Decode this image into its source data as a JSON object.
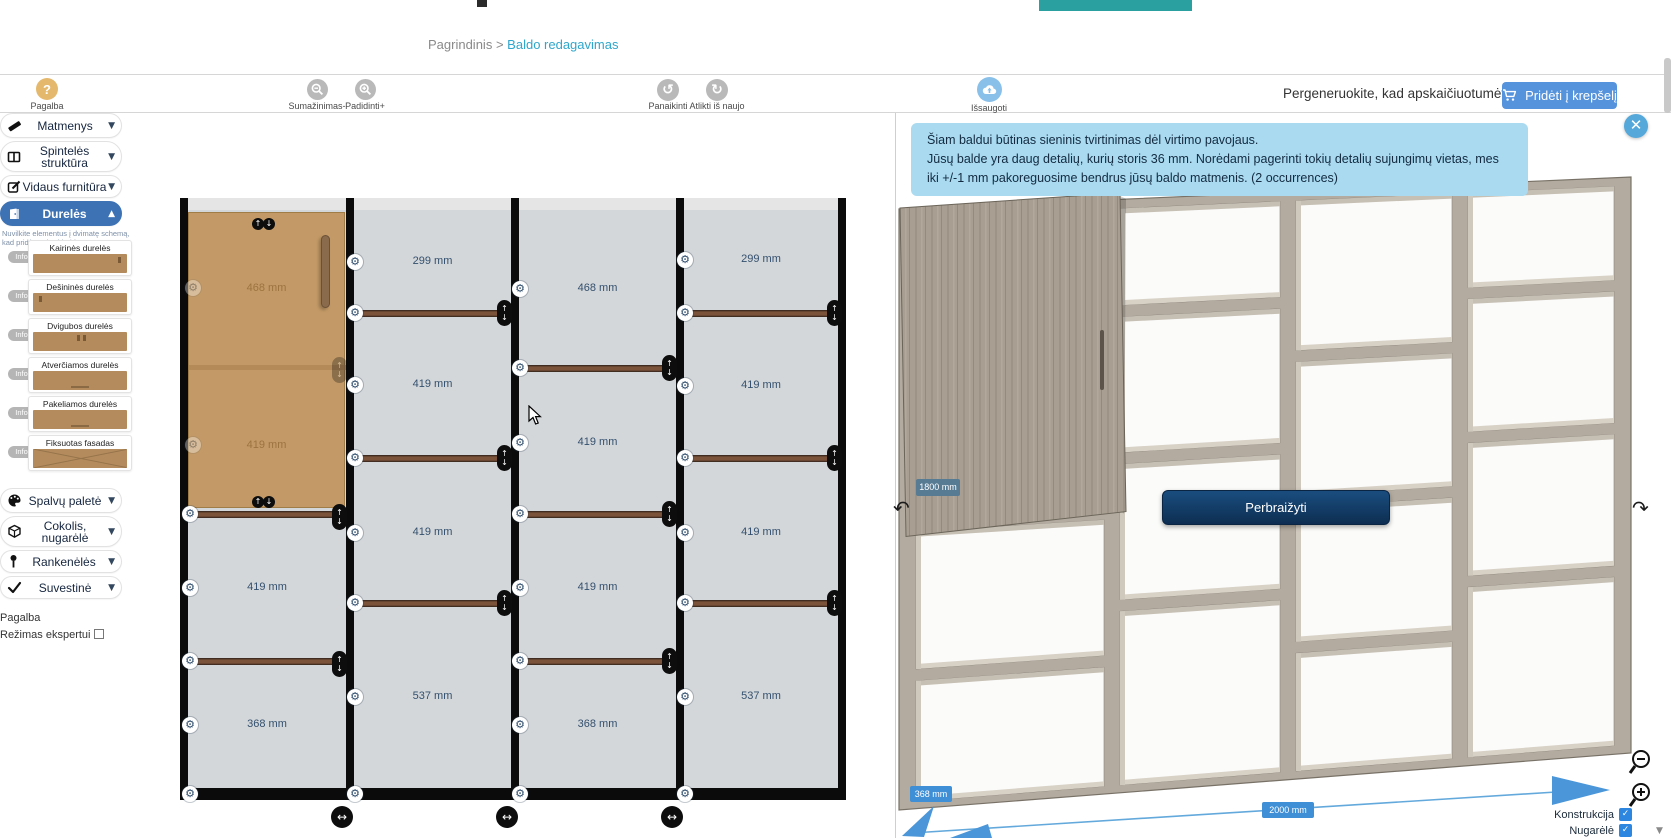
{
  "header": {
    "breadcrumb": {
      "home": "Pagrindinis",
      "separator": ">",
      "current": "Baldo redagavimas"
    }
  },
  "toolbar": {
    "help_label": "Pagalba",
    "zoom_out_label": "Sumažinimas-",
    "zoom_in_label": "Padidinti+",
    "undo_label": "Panaikinti",
    "redo_label": "Atlikti iš naujo",
    "save_label": "Išsaugoti",
    "regen_hint": "Pergeneruokite, kad apskaičiuotumėte kainą",
    "add_to_cart_label": "Pridėti į krepšelį"
  },
  "sidebar": {
    "sections": [
      {
        "label": "Matmenys"
      },
      {
        "label": "Spintelės struktūra"
      },
      {
        "label": "Vidaus furnitūra"
      },
      {
        "label": "Durelės"
      },
      {
        "label": "Spalvų paletė"
      },
      {
        "label": "Cokolis, nugarėlė"
      },
      {
        "label": "Rankenėlės"
      },
      {
        "label": "Suvestinė"
      }
    ],
    "drag_hint": "Nuvilkite elementus į dvimatę schemą, kad pridėtumėte į baldą:",
    "info_label": "Info",
    "door_items": [
      {
        "label": "Kairinės durelės"
      },
      {
        "label": "Dešininės durelės"
      },
      {
        "label": "Dvigubos durelės"
      },
      {
        "label": "Atverčiamos durelės"
      },
      {
        "label": "Pakeliamos durelės"
      },
      {
        "label": "Fiksuotas fasadas"
      }
    ],
    "help_link": "Pagalba",
    "expert_mode_label": "Režimas ekspertui"
  },
  "schematic": {
    "columns": [
      {
        "cells": [
          "468 mm",
          "419 mm",
          "419 mm",
          "368 mm"
        ],
        "has_door": true
      },
      {
        "cells": [
          "299 mm",
          "419 mm",
          "419 mm",
          "537 mm"
        ]
      },
      {
        "cells": [
          "468 mm",
          "419 mm",
          "419 mm",
          "368 mm"
        ]
      },
      {
        "cells": [
          "299 mm",
          "419 mm",
          "419 mm",
          "537 mm"
        ]
      }
    ]
  },
  "viewer": {
    "notice_line1": "Šiam baldui būtinas sieninis tvirtinimas dėl virtimo pavojaus.",
    "notice_line2": "Jūsų balde yra daug detalių, kurių storis 36 mm. Norėdami pagerinti tokių detalių sujungimų vietas, mes iki +/-1 mm pakoreguosime bendrus jūsų baldo matmenis. (2 occurrences)",
    "redraw_button": "Perbraižyti",
    "dim_height": "1800 mm",
    "dim_depth": "368 mm",
    "dim_width": "2000 mm",
    "toggles": [
      {
        "label": "Konstrukcija",
        "checked": true
      },
      {
        "label": "Nugarėlė",
        "checked": true
      }
    ]
  },
  "colors": {
    "sidebar_active": "#3d72b4",
    "add_to_cart": "#5593dd",
    "notice_bg": "#a9daf0",
    "help_circle": "#e5b96d",
    "save_circle": "#89c0ea",
    "gray_circle": "#b9b9b9",
    "breadcrumb_link": "#2fa6cb",
    "dim_badge_blue": "#3f8fd6",
    "dim_badge_slate": "#587b94",
    "redraw_navy": "#0d2e51",
    "checkbox_blue": "#2d86e0"
  }
}
